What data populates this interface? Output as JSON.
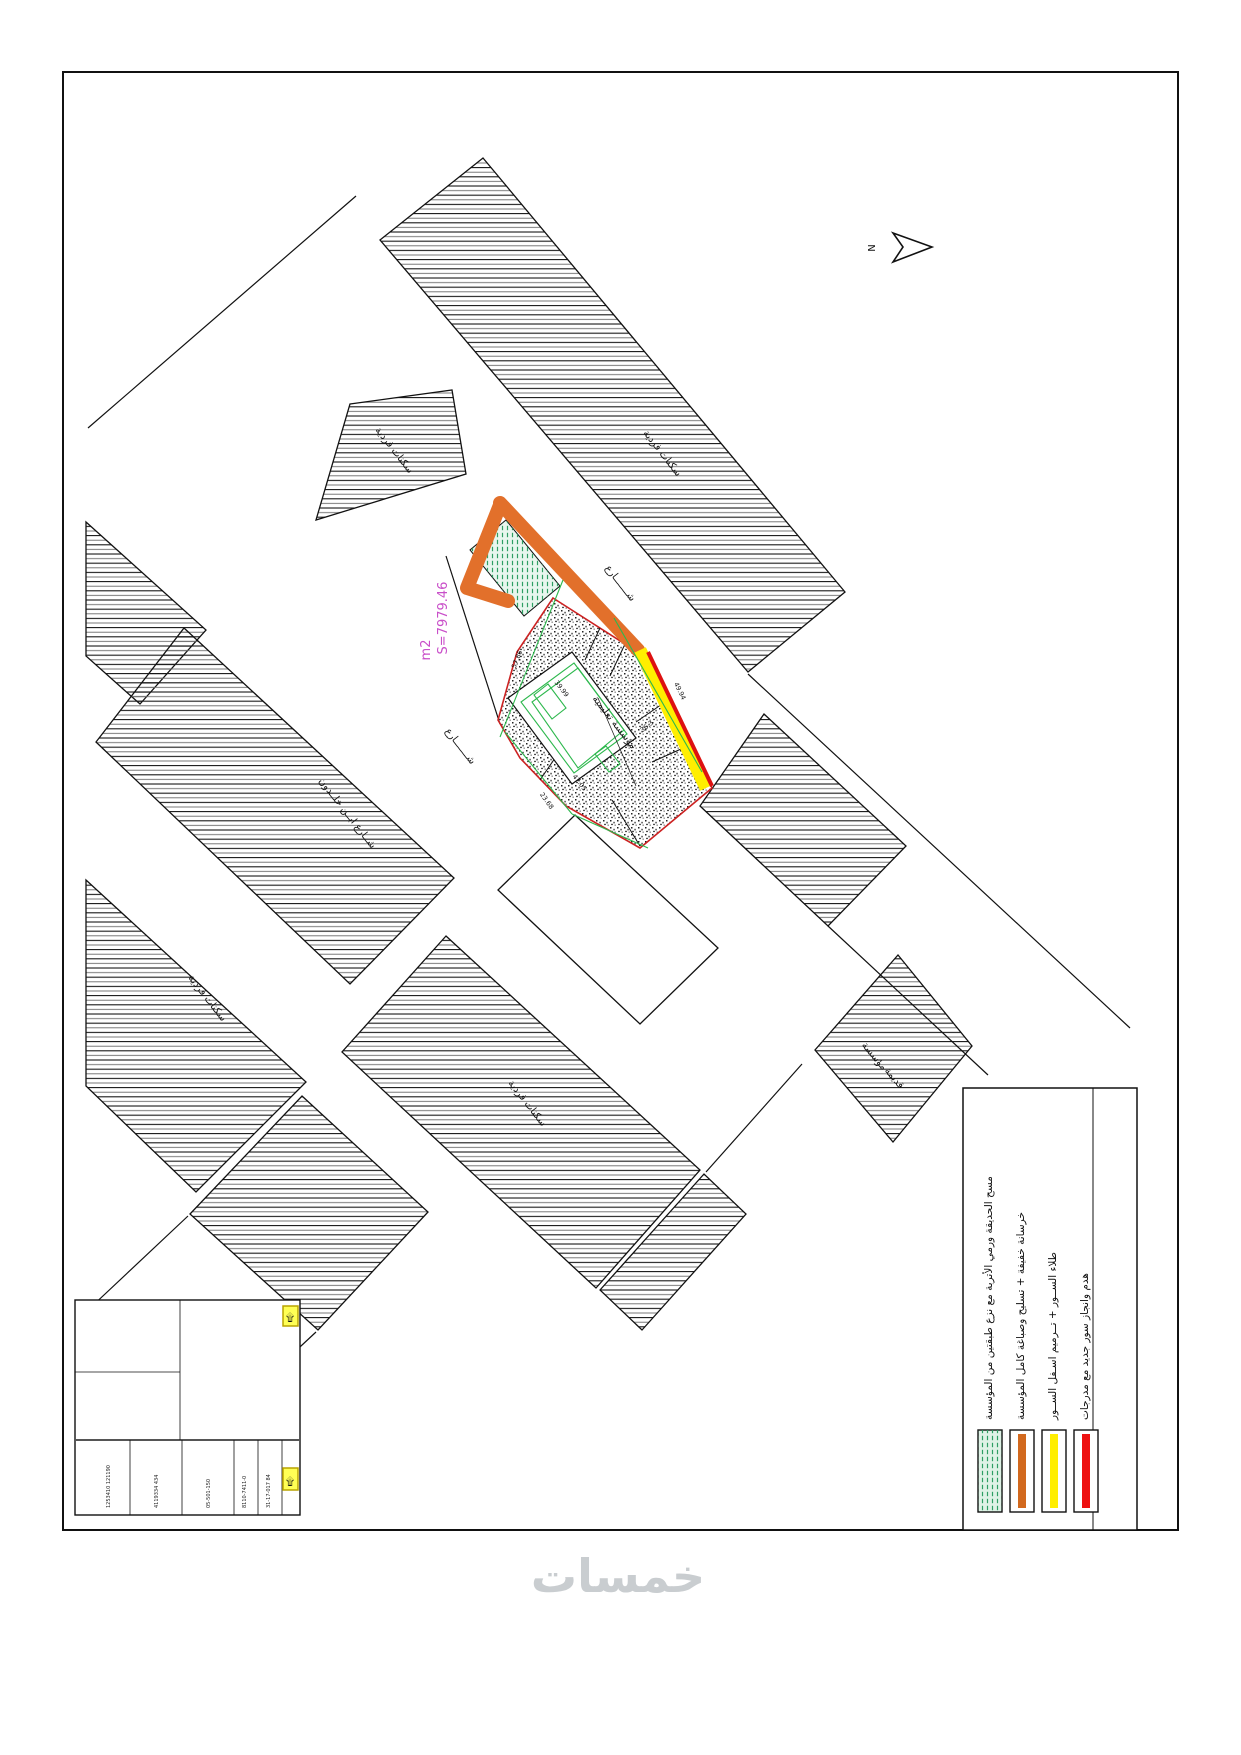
{
  "page": {
    "watermark": "خمسات"
  },
  "north": {
    "label": "N"
  },
  "plot": {
    "area_line1": "S=7979.46",
    "area_line2": "m2",
    "inner_label": "مؤسسة تعليمية",
    "dims": {
      "left": "57.86",
      "frontage": "49.94",
      "bottom_left": "23.68",
      "inner_bottom": "47.05",
      "inner_mid": "39.99",
      "inner_right": "36.3"
    }
  },
  "map_labels": {
    "residential": "سكنات فردية",
    "street": "شـــــــارع",
    "street_ibn_khaldoun": "شــارع ابــن خلــدون",
    "old_block_line1": "مؤسسة",
    "old_block_line2": "قديمة"
  },
  "legend": {
    "entries": [
      {
        "swatch": "green-hatch",
        "color": "#bfe8cf",
        "text": "مسح الحديقة ورمي الأتربة مع نزع طبقتين من المؤسسة"
      },
      {
        "swatch": "bar",
        "color": "#d2691e",
        "text": "خرسانة خفيفة + تسليح وصباغة كامل المؤسسة"
      },
      {
        "swatch": "bar",
        "color": "#ffee00",
        "text": "طلاء الســور + تــرميم اسـفل الســور"
      },
      {
        "swatch": "bar",
        "color": "#ee1111",
        "text": "هدم وانجاز سور جديد مع مدرجات"
      }
    ]
  },
  "title_block": {
    "micro_texts": [
      "1253410 121190",
      "4119334 434",
      "05-501-150",
      "8110-7411-0",
      "31-17-017 84"
    ]
  }
}
